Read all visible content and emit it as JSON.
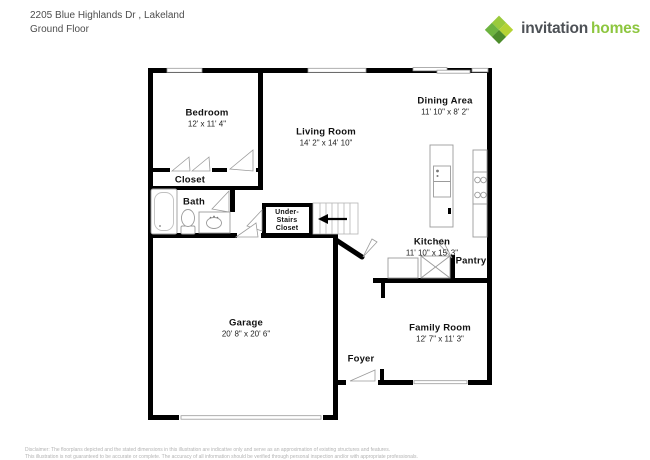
{
  "header": {
    "address": "2205 Blue Highlands Dr , Lakeland",
    "floor": "Ground Floor"
  },
  "logo": {
    "brand_primary": "invitation",
    "brand_secondary": "homes",
    "colors": {
      "brand_green": "#8dc63f",
      "brand_dark_text": "#4d5156",
      "mark_greens": [
        "#9aca3c",
        "#6db33f",
        "#b5d334",
        "#4c8c2b"
      ]
    }
  },
  "plan": {
    "wall_color": "#000000",
    "fixture_line_color": "#9b9b9b",
    "icons": {
      "stairs_arrow": "left-arrow"
    }
  },
  "rooms": {
    "bedroom": {
      "name": "Bedroom",
      "dims": "12' x 11' 4\""
    },
    "living_room": {
      "name": "Living Room",
      "dims": "14' 2\" x 14' 10\""
    },
    "dining_area": {
      "name": "Dining Area",
      "dims": "11' 10\" x 8' 2\""
    },
    "kitchen": {
      "name": "Kitchen",
      "dims": "11' 10\" x 15' 3\""
    },
    "garage": {
      "name": "Garage",
      "dims": "20' 8\" x 20' 6\""
    },
    "family_room": {
      "name": "Family Room",
      "dims": "12' 7\" x 11' 3\""
    },
    "closet": {
      "name": "Closet"
    },
    "bath": {
      "name": "Bath"
    },
    "under_stairs_closet": {
      "name": "Under-\nStairs\nCloset"
    },
    "pantry": {
      "name": "Pantry"
    },
    "foyer": {
      "name": "Foyer"
    }
  },
  "disclaimer": {
    "line1": "Disclaimer: The floorplans depicted and the stated dimensions in this illustration are indicative only and serve as an approximation of existing structures and features.",
    "line2": "This illustration is not guaranteed to be accurate or complete. The accuracy of all information should be verified through personal inspection and/or with appropriate professionals."
  }
}
